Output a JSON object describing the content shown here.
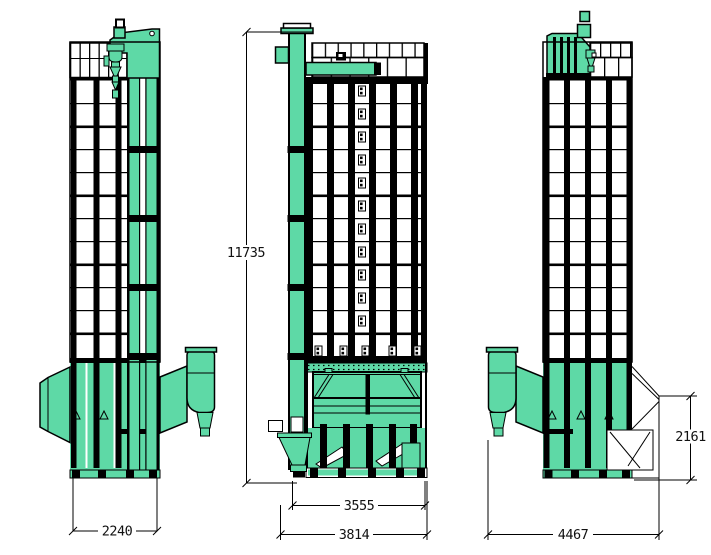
{
  "colors": {
    "machine": "#5ed9a6",
    "lines": "#000000",
    "background": "#ffffff",
    "dim_text": "#111111"
  },
  "dimensions": {
    "front_total_height": "11735",
    "left_base_width": "2240",
    "front_inner_width": "3555",
    "front_overall_width": "3814",
    "right_overall_width": "4467",
    "right_lower_height": "2161"
  }
}
